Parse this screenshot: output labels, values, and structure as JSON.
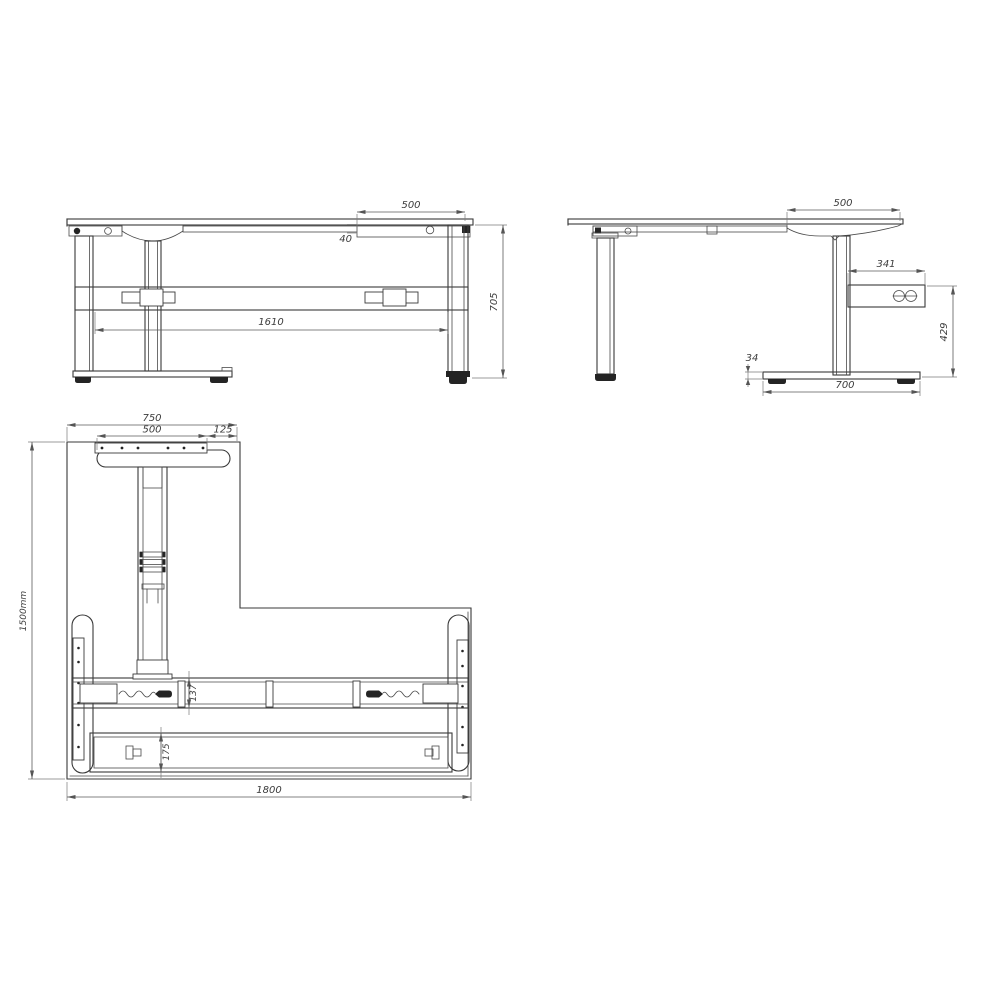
{
  "drawing": {
    "views": {
      "front": "front-elevation",
      "side": "side-elevation",
      "plan": "bottom-plan"
    },
    "line_color": "#3a3a3a",
    "dim_color": "#5a5a5a"
  },
  "dims": {
    "front": {
      "tray_width": "500",
      "top_thickness": "40",
      "leg_span": "1610",
      "overall_height": "705"
    },
    "side": {
      "return_width": "500",
      "control_box_width": "341",
      "box_to_floor": "429",
      "foot_height": "34",
      "foot_length": "700"
    },
    "plan": {
      "foot_overall": "750",
      "plate_width": "500",
      "edge_offset": "125",
      "overall_depth": "1500mm",
      "beam_depth": "137",
      "tray_depth": "175",
      "overall_width": "1800"
    }
  }
}
